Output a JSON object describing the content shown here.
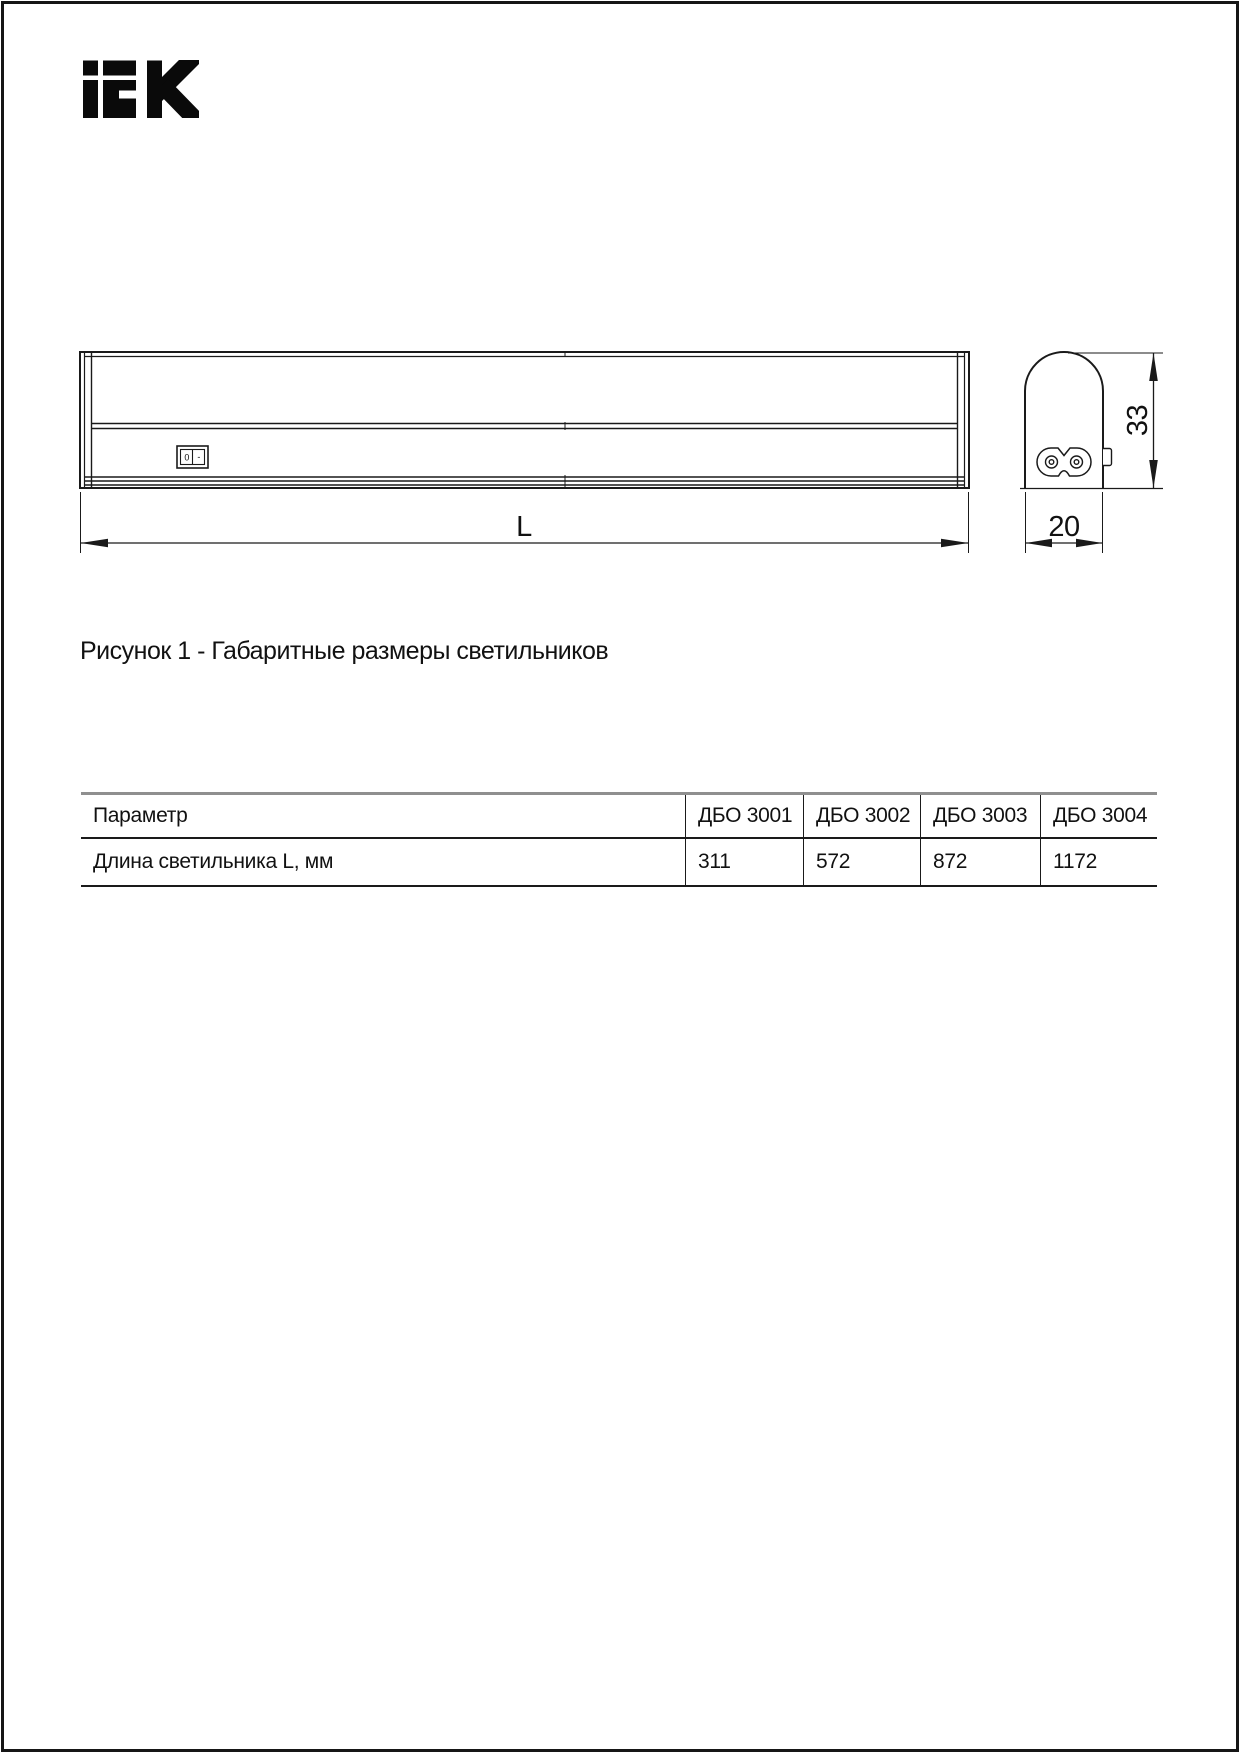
{
  "page": {
    "background": "#ffffff",
    "frame_color": "#161616"
  },
  "logo": {
    "brand": "IEK"
  },
  "colors": {
    "drawing_line": "#1a1a1a",
    "table_top_border": "#8f8f8f",
    "table_line": "#1a1a1a"
  },
  "drawing": {
    "length_label": "L",
    "height_label": "33",
    "width_label": "20",
    "switch_off": "0",
    "switch_on": "-"
  },
  "caption": "Рисунок 1 - Габаритные размеры светильников",
  "table": {
    "headers": [
      "Параметр",
      "ДБО 3001",
      "ДБО 3002",
      "ДБО 3003",
      "ДБО 3004"
    ],
    "rows": [
      {
        "parameter": "Длина светильника L, мм",
        "values": [
          "311",
          "572",
          "872",
          "1172"
        ]
      }
    ]
  }
}
